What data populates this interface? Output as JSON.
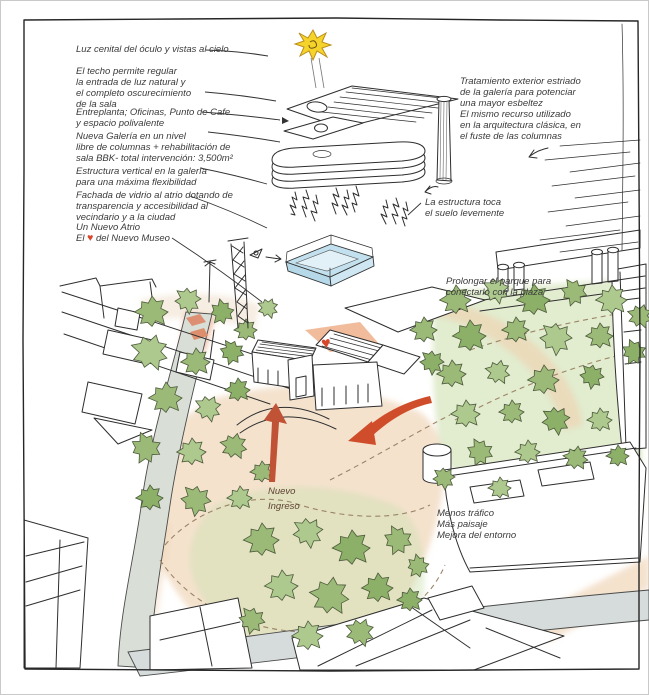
{
  "annotations": {
    "oculus": "Luz cenital del óculo y vistas al cielo",
    "roof": "El techo permite regular\nla entrada de luz natural y\nel completo oscurecimiento\nde la sala",
    "mezzanine": "Entreplanta; Oficinas, Punto de Cafe\ny espacio polivalente",
    "gallery": "Nueva Galería en un nivel\nlibre de columnas + rehabilitación de\nsala BBK- total intervención: 3,500m²",
    "vertical_structure": "Estructura vertical en la galería\npara una máxima flexibilidad",
    "glass_facade": "Fachada de vidrio al atrio dotando de\ntransparencia y accesibilidad al\nvecindario y a la ciudad",
    "atrium_line1": "Un Nuevo Atrio",
    "atrium_el": "El",
    "atrium_heart": "♥",
    "atrium_rest": "del Nuevo Museo",
    "exterior_treatment": "Tratamiento exterior estriado\nde la galería para potenciar\nuna mayor esbeltez\nEl mismo recurso utilizado\nen la arquitectura clásica, en\nel fuste de las columnas",
    "structure_ground": "La estructura toca\nel suelo levemente",
    "park_extension": "Prolongar el parque para\nconectarlo con la plaza",
    "new_entrance": "Nuevo\nIngreso",
    "traffic": "Menos tráfico\nMás paisaje\nMejora del entorno"
  },
  "museum": {
    "roof_heart": "♥"
  },
  "colors": {
    "c-heart": "#d9472b",
    "c-arrow": "#cf4d2a",
    "c-sun": "#f5d32b",
    "c-glass": "#c2e0ee",
    "c-foliage": "#9cba77",
    "c-foliage2": "#aec98e",
    "c-foliage3": "#8db069",
    "c-ground": "#f0d5b8",
    "c-road": "#d9ded7",
    "c-grass": "#d2e2b6",
    "c-ink": "#2e2e2e"
  }
}
